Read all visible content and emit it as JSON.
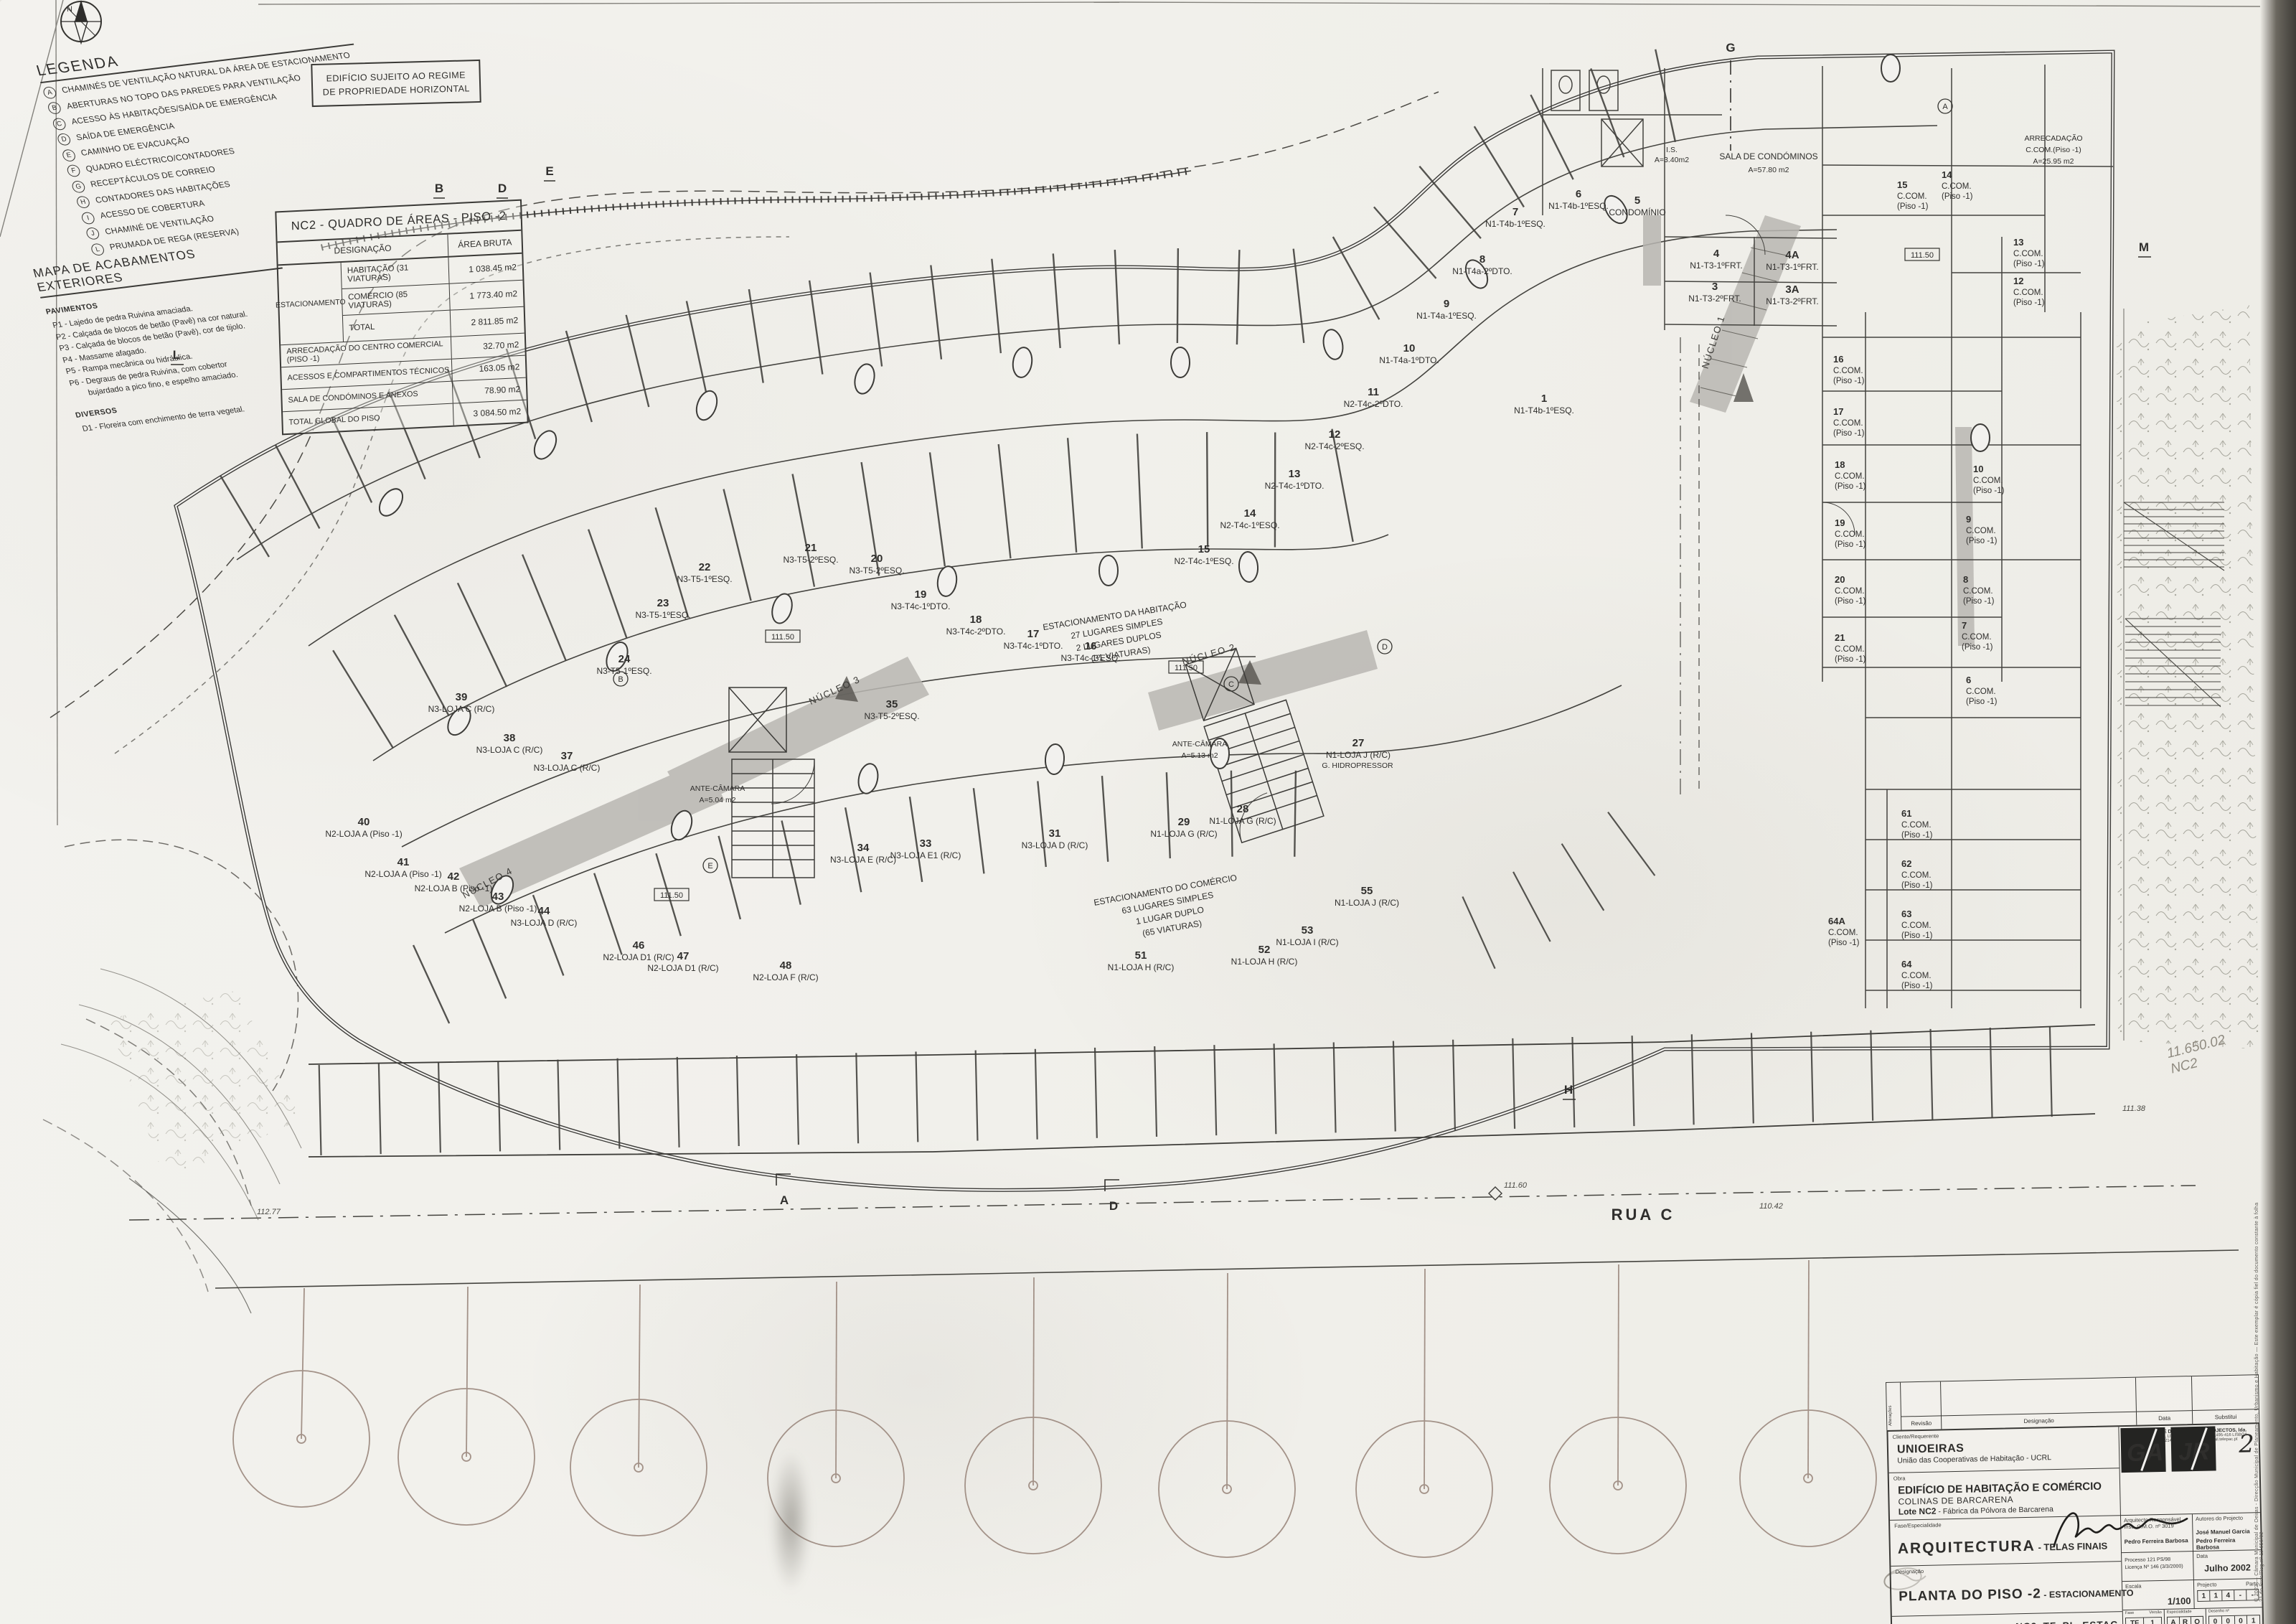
{
  "sheet": {
    "north": "N",
    "note_line1": "EDIFÍCIO SUJEITO AO REGIME",
    "note_line2": "DE PROPRIEDADE HORIZONTAL",
    "pencil_line1": "11.650.02",
    "pencil_line2": "NC2",
    "stamp": "© 2022  —  Câmara Municipal de Oeiras - Direcção Municipal de Planeamento, Urbanismo e Habitação  —  Este exemplar é cópia fiel do documento constante à folha 21 do Proc/Reg nº 11.650/02"
  },
  "legend": {
    "title": "LEGENDA",
    "items": [
      {
        "k": "A",
        "t": "CHAMINÉS DE VENTILAÇÃO NATURAL DA ÁREA DE ESTACIONAMENTO"
      },
      {
        "k": "B",
        "t": "ABERTURAS NO TOPO DAS PAREDES PARA VENTILAÇÃO"
      },
      {
        "k": "C",
        "t": "ACESSO ÀS HABITAÇÕES/SAÍDA DE EMERGÊNCIA"
      },
      {
        "k": "D",
        "t": "SAÍDA DE EMERGÊNCIA"
      },
      {
        "k": "E",
        "t": "CAMINHO DE EVACUAÇÃO"
      },
      {
        "k": "F",
        "t": "QUADRO ELÉCTRICO/CONTADORES"
      },
      {
        "k": "G",
        "t": "RECEPTÁCULOS DE CORREIO"
      },
      {
        "k": "H",
        "t": "CONTADORES DAS HABITAÇÕES"
      },
      {
        "k": "I",
        "t": "ACESSO DE COBERTURA"
      },
      {
        "k": "J",
        "t": "CHAMINÉ DE VENTILAÇÃO"
      },
      {
        "k": "L",
        "t": "PRUMADA DE REGA (RESERVA)"
      }
    ]
  },
  "areas_table": {
    "title": "NC2 - QUADRO DE ÁREAS - PISO -2",
    "col_designacao": "DESIGNAÇÃO",
    "col_area": "ÁREA BRUTA",
    "group_label": "ESTACIONAMENTO",
    "group_rows": [
      {
        "d": "HABITAÇÃO (31 VIATURAS)",
        "a": "1 038.45 m2"
      },
      {
        "d": "COMÉRCIO (85 VIATURAS)",
        "a": "1 773.40 m2"
      },
      {
        "d": "TOTAL",
        "a": "2 811.85 m2"
      }
    ],
    "rows": [
      {
        "d": "ARRECADAÇÃO DO CENTRO COMERCIAL (PISO -1)",
        "a": "32.70 m2"
      },
      {
        "d": "ACESSOS E COMPARTIMENTOS TÉCNICOS",
        "a": "163.05 m2"
      },
      {
        "d": "SALA DE CONDÓMINOS E ANEXOS",
        "a": "78.90 m2"
      },
      {
        "d": "TOTAL GLOBAL DO PISO",
        "a": "3 084.50 m2"
      }
    ]
  },
  "finishes": {
    "title": "MAPA DE ACABAMENTOS EXTERIORES",
    "s1": "PAVIMENTOS",
    "items": [
      "P1 - Lajedo de pedra Ruivina amaciada.",
      "P2 - Calçada de blocos de betão (Pavê) na cor natural.",
      "P3 - Calçada de blocos de betão (Pavê), cor de tijolo.",
      "P4 - Massame afagado.",
      "P5 - Rampa mecânica ou hidráulica.",
      "P6 - Degraus de pedra Ruivina, com cobertor",
      "bujardado a pico fino, e espelho amaciado."
    ],
    "s2": "DIVERSOS",
    "items2": [
      "D1 - Floreira com enchimento de terra vegetal."
    ]
  },
  "plan": {
    "road": "RUA C",
    "room_t": "C.COM.",
    "room_p": "(Piso -1)",
    "level": "111.50",
    "level_road": "111.60",
    "dims": {
      "d1": "112.77",
      "d2": "110.42",
      "d3": "111.38"
    },
    "axes": {
      "a": "A",
      "b": "B",
      "d": "D",
      "e": "E",
      "g": "G",
      "h": "H",
      "l": "L",
      "m": "M"
    },
    "circled": [
      "A",
      "B",
      "C",
      "D",
      "E"
    ],
    "cores": {
      "n1": "NÚCLEO 1",
      "n2": "NÚCLEO 2",
      "n3": "NÚCLEO 3",
      "n4": "NÚCLEO 4"
    },
    "zone_hab": [
      "ESTACIONAMENTO DA HABITAÇÃO",
      "27 LUGARES SIMPLES",
      "2 LUGARES DUPLOS",
      "(31 VIATURAS)"
    ],
    "zone_com": [
      "ESTACIONAMENTO DO COMÉRCIO",
      "63 LUGARES SIMPLES",
      "1 LUGAR DUPLO",
      "(65 VIATURAS)"
    ],
    "misc": {
      "sala1": "SALA DE CONDÓMINOS",
      "sala2": "A=57.80 m2",
      "arr1": "ARRECADAÇÃO",
      "arr2": "C.COM.(Piso -1)",
      "arr3": "A=25.95 m2",
      "is1": "I.S.",
      "is2": "A=3.40m2",
      "ante": "ANTE-CÂMARA",
      "antea1": "A=5.13 m2",
      "antea2": "A=5.04 m2",
      "hidro": "G. HIDROPRESSOR"
    },
    "stalls": [
      {
        "n": "1",
        "t": "N1-T4b-1ºESQ."
      },
      {
        "n": "3",
        "t": "N1-T3-2ºFRT."
      },
      {
        "n": "3A",
        "t": "N1-T3-2ºFRT."
      },
      {
        "n": "4",
        "t": "N1-T3-1ºFRT."
      },
      {
        "n": "4A",
        "t": "N1-T3-1ºFRT."
      },
      {
        "n": "5",
        "t": "CONDOMÍNIO"
      },
      {
        "n": "6",
        "t": "N1-T4b-1ºESQ."
      },
      {
        "n": "7",
        "t": "N1-T4b-1ºESQ."
      },
      {
        "n": "8",
        "t": "N1-T4a-2ºDTO."
      },
      {
        "n": "9",
        "t": "N1-T4a-1ºESQ."
      },
      {
        "n": "10",
        "t": "N1-T4a-1ºDTO."
      },
      {
        "n": "11",
        "t": "N2-T4c-2ºDTO."
      },
      {
        "n": "12",
        "t": "N2-T4c-2ºESQ."
      },
      {
        "n": "13",
        "t": "N2-T4c-1ºDTO."
      },
      {
        "n": "14",
        "t": "N2-T4c-1ºESQ."
      },
      {
        "n": "15",
        "t": "N2-T4c-1ºESQ."
      },
      {
        "n": "16",
        "t": "N3-T4c-1ºESQ."
      },
      {
        "n": "17",
        "t": "N3-T4c-1ºDTO."
      },
      {
        "n": "18",
        "t": "N3-T4c-2ºDTO."
      },
      {
        "n": "19",
        "t": "N3-T4c-1ºDTO."
      },
      {
        "n": "20",
        "t": "N3-T5-2ºESQ."
      },
      {
        "n": "21",
        "t": "N3-T5-2ºESQ."
      },
      {
        "n": "22",
        "t": "N3-T5-1ºESQ."
      },
      {
        "n": "23",
        "t": "N3-T5-1ºESQ."
      },
      {
        "n": "24",
        "t": "N3-T5-1ºESQ."
      },
      {
        "n": "27",
        "t": "N1-LOJA J (R/C)"
      },
      {
        "n": "28",
        "t": "N1-LOJA G (R/C)"
      },
      {
        "n": "29",
        "t": "N1-LOJA G (R/C)"
      },
      {
        "n": "31",
        "t": "N3-LOJA D (R/C)"
      },
      {
        "n": "33",
        "t": "N3-LOJA E1 (R/C)"
      },
      {
        "n": "34",
        "t": "N3-LOJA E (R/C)"
      },
      {
        "n": "35",
        "t": "N3-T5-2ºESQ."
      },
      {
        "n": "37",
        "t": "N3-LOJA C (R/C)"
      },
      {
        "n": "38",
        "t": "N3-LOJA C (R/C)"
      },
      {
        "n": "39",
        "t": "N3-LOJA C (R/C)"
      },
      {
        "n": "40",
        "t": "N2-LOJA A (Piso -1)"
      },
      {
        "n": "41",
        "t": "N2-LOJA A (Piso -1)"
      },
      {
        "n": "42",
        "t": "N2-LOJA B (Piso -1)"
      },
      {
        "n": "43",
        "t": "N2-LOJA B (Piso -1)"
      },
      {
        "n": "44",
        "t": "N3-LOJA D (R/C)"
      },
      {
        "n": "46",
        "t": "N2-LOJA D1 (R/C)"
      },
      {
        "n": "47",
        "t": "N2-LOJA D1 (R/C)"
      },
      {
        "n": "48",
        "t": "N2-LOJA F (R/C)"
      },
      {
        "n": "51",
        "t": "N1-LOJA H (R/C)"
      },
      {
        "n": "52",
        "t": "N1-LOJA H (R/C)"
      },
      {
        "n": "53",
        "t": "N1-LOJA I (R/C)"
      },
      {
        "n": "55",
        "t": "N1-LOJA J (R/C)"
      }
    ],
    "rooms": [
      {
        "n": "16"
      },
      {
        "n": "17"
      },
      {
        "n": "18"
      },
      {
        "n": "19"
      },
      {
        "n": "20"
      },
      {
        "n": "21"
      },
      {
        "n": "6"
      },
      {
        "n": "7"
      },
      {
        "n": "8"
      },
      {
        "n": "9"
      },
      {
        "n": "10"
      },
      {
        "n": "12"
      },
      {
        "n": "13"
      },
      {
        "n": "14"
      },
      {
        "n": "15"
      },
      {
        "n": "61"
      },
      {
        "n": "62"
      },
      {
        "n": "63"
      },
      {
        "n": "64"
      },
      {
        "n": "64A"
      }
    ]
  },
  "titleblock": {
    "rev": {
      "alt": "Alterações",
      "revisao": "Revisão",
      "designacao": "Designação",
      "data": "Data",
      "substitui": "Substitui"
    },
    "client_label": "Cliente/Requerente",
    "client_name": "UNIOEIRAS",
    "client_sub": "União das Cooperativas de Habitação - UCRL",
    "work_label": "Obra",
    "work1": "EDIFÍCIO DE HABITAÇÃO E COMÉRCIO",
    "work2": "COLINAS DE BARCARENA",
    "work3a": "Lote NC2",
    "work3b": " - Fábrica da Pólvora de Barcarena",
    "phase_label": "Fase/Especialidade",
    "phase1": "ARQUITECTURA",
    "phase2": " - TELAS FINAIS",
    "desig_label": "Designação",
    "desig1": "PLANTA DO PISO -2",
    "desig2": " - ESTACIONAMENTO",
    "registo_label": "Registo",
    "registo_value": "NC2_TF_PL_ESTAC",
    "logo1": "GA",
    "logo2": "JR",
    "sheet_no": "2",
    "logo_caption": "GAJR - GABINETE DE ESTUDOS E PROJECTOS, lda.",
    "logo_addr": "R. Sacadura de Gama, Lt. 39 - 2 Caxias, 2º Dto.  1495-416 LISBOA",
    "logo_tel": "Tel. 214462086/7  Fax 214465298  Email: gajr@mail.telepac.pt",
    "arch_label": "Arquitecto Responsável",
    "arch_sub": "Insc. C.M.O. nº 3019",
    "arch_name": "Pedro Ferreira Barbosa",
    "authors_label": "Autores do Projecto",
    "author1": "José Manuel Garcia",
    "author2": "Pedro Ferreira Barbosa",
    "proc1": "Processo 121 PS/98",
    "proc2": "Licença Nº 146 (3/3/2000)",
    "data_label": "Data",
    "data_value": "Julho 2002",
    "escala_label": "Escala",
    "escala_value": "1/100",
    "projecto_label": "Projecto",
    "parte_label": "Parte",
    "projecto_cells": [
      "1",
      "1",
      "4",
      "-",
      "-"
    ],
    "fase_label": "Fase",
    "versao_label": "Versão",
    "fase_cells": [
      "TF",
      "1"
    ],
    "esp_label": "Especialidade",
    "esp_cells": [
      "A",
      "R",
      "Q"
    ],
    "des_label": "Desenho nº",
    "des_cells": [
      "0",
      "0",
      "0",
      "1"
    ],
    "disclaimer": "ESTE DESENHO É PROPRIEDADE INTELECTUAL DOS AUTORES, NÃO PODENDO SER REPRODUZIDO, ALTERADO, DIVULGADO, OU USADO PARA OUTRO FIM, NO TODO OU EM PARTE, SEM AUTORIZAÇÃO EXPRESSA DOS MESMOS. RESERVADOS TODOS OS DIREITOS DE ACORDO COM A LEGISLAÇÃO EM VIGOR."
  }
}
